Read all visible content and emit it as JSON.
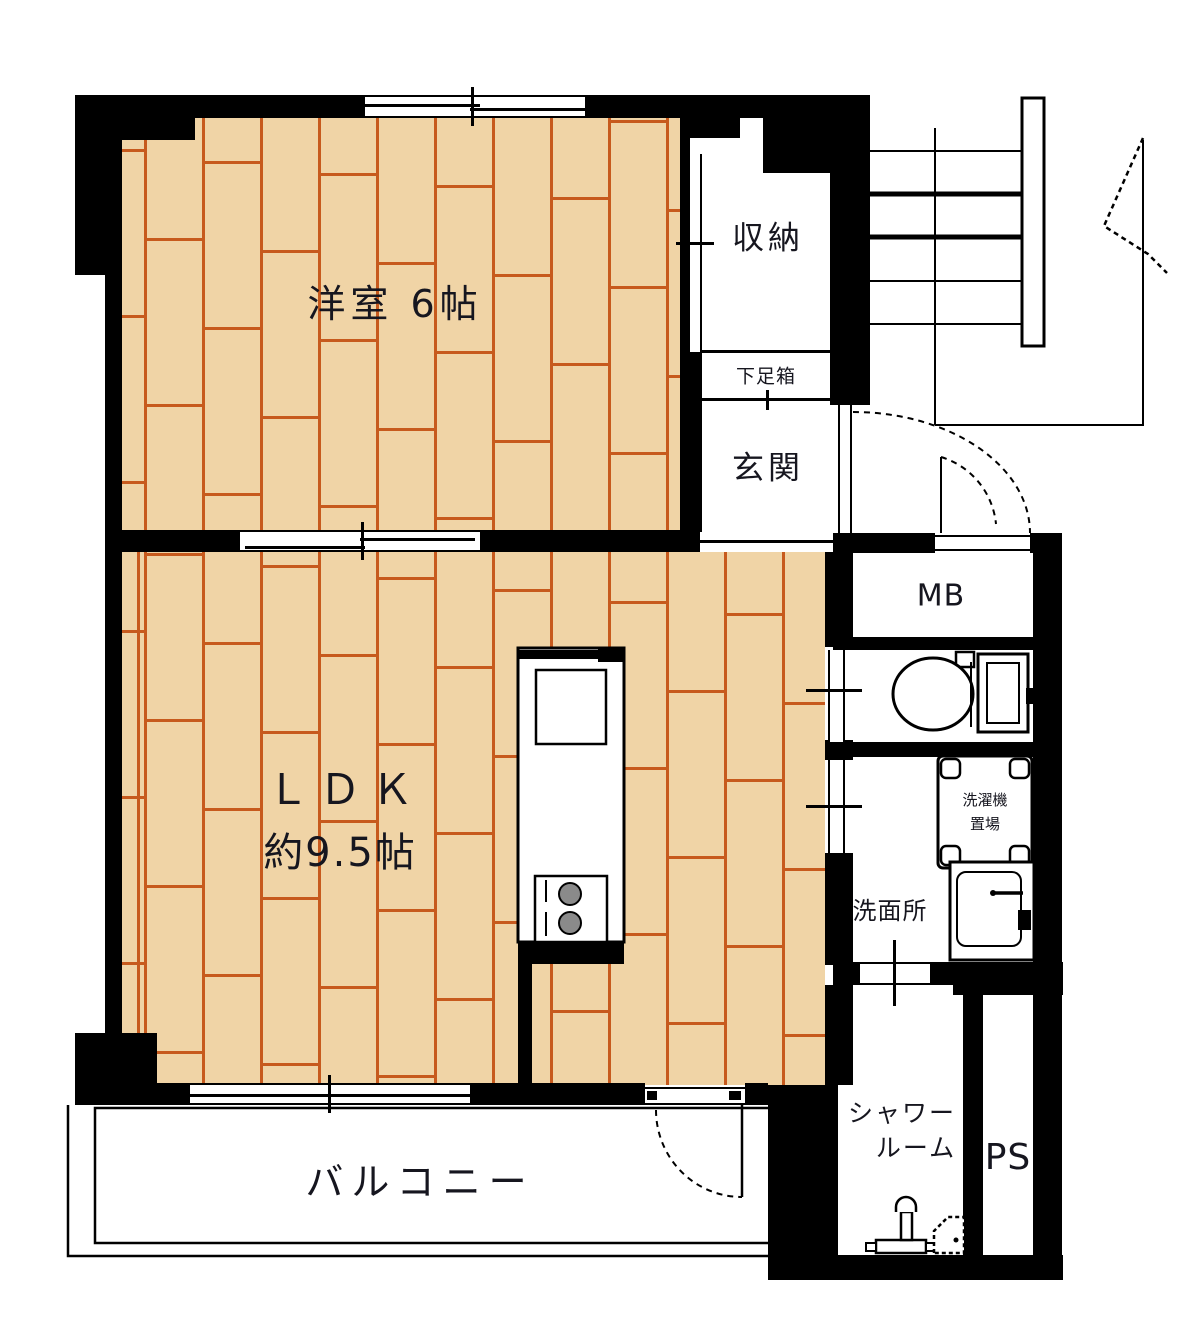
{
  "plan": {
    "type": "apartment-floor-plan",
    "colors": {
      "wall": "#000000",
      "floor": "#f0d4a6",
      "plank_line": "#c75a1d",
      "background": "#ffffff",
      "label_text": "#16161f"
    },
    "rooms": {
      "western": {
        "label": "洋室 6帖"
      },
      "ldk": {
        "line1": "ＬＤＫ",
        "line2": "約9.5帖"
      },
      "closet": {
        "label": "収納"
      },
      "shoe_box": {
        "label": "下足箱"
      },
      "entrance": {
        "label": "玄関"
      },
      "meter_box": {
        "label": "MB"
      },
      "washer_place": {
        "line1": "洗濯機",
        "line2": "置場"
      },
      "washroom": {
        "label": "洗面所"
      },
      "shower": {
        "line1": "シャワー",
        "line2": "ルーム"
      },
      "pipe_space": {
        "label": "PS"
      },
      "balcony": {
        "label": "バルコニー"
      }
    },
    "icons": [
      "toilet-icon",
      "washing-machine-icon",
      "bathroom-sink-icon",
      "shower-fixture-icon",
      "kitchen-unit-icon",
      "kitchen-sink-icon",
      "gas-stove-icon",
      "staircase-icon",
      "entry-door-swing-icon",
      "balcony-door-swing-icon",
      "sliding-window-icon",
      "sliding-door-icon",
      "stair-break-arrow-icon"
    ]
  }
}
